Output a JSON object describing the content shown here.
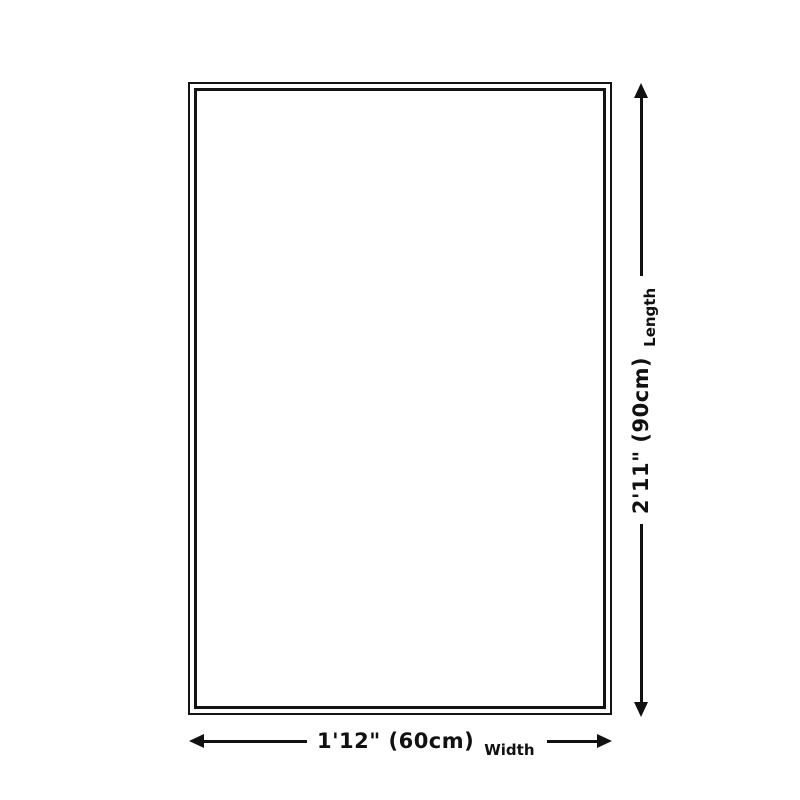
{
  "page": {
    "background_color": "#ffffff",
    "line_color": "#111111"
  },
  "diagram": {
    "kind": "product-size-diagram",
    "shape": "rectangle-outline-double-border",
    "dimensions": {
      "length": {
        "value": "2'11\" (90cm)",
        "label": "Length"
      },
      "width": {
        "value": "1'12\" (60cm)",
        "label": "Width"
      }
    },
    "icons": {
      "up_arrow": "arrow-up",
      "down_arrow": "arrow-down",
      "left_arrow": "arrow-left",
      "right_arrow": "arrow-right"
    }
  }
}
